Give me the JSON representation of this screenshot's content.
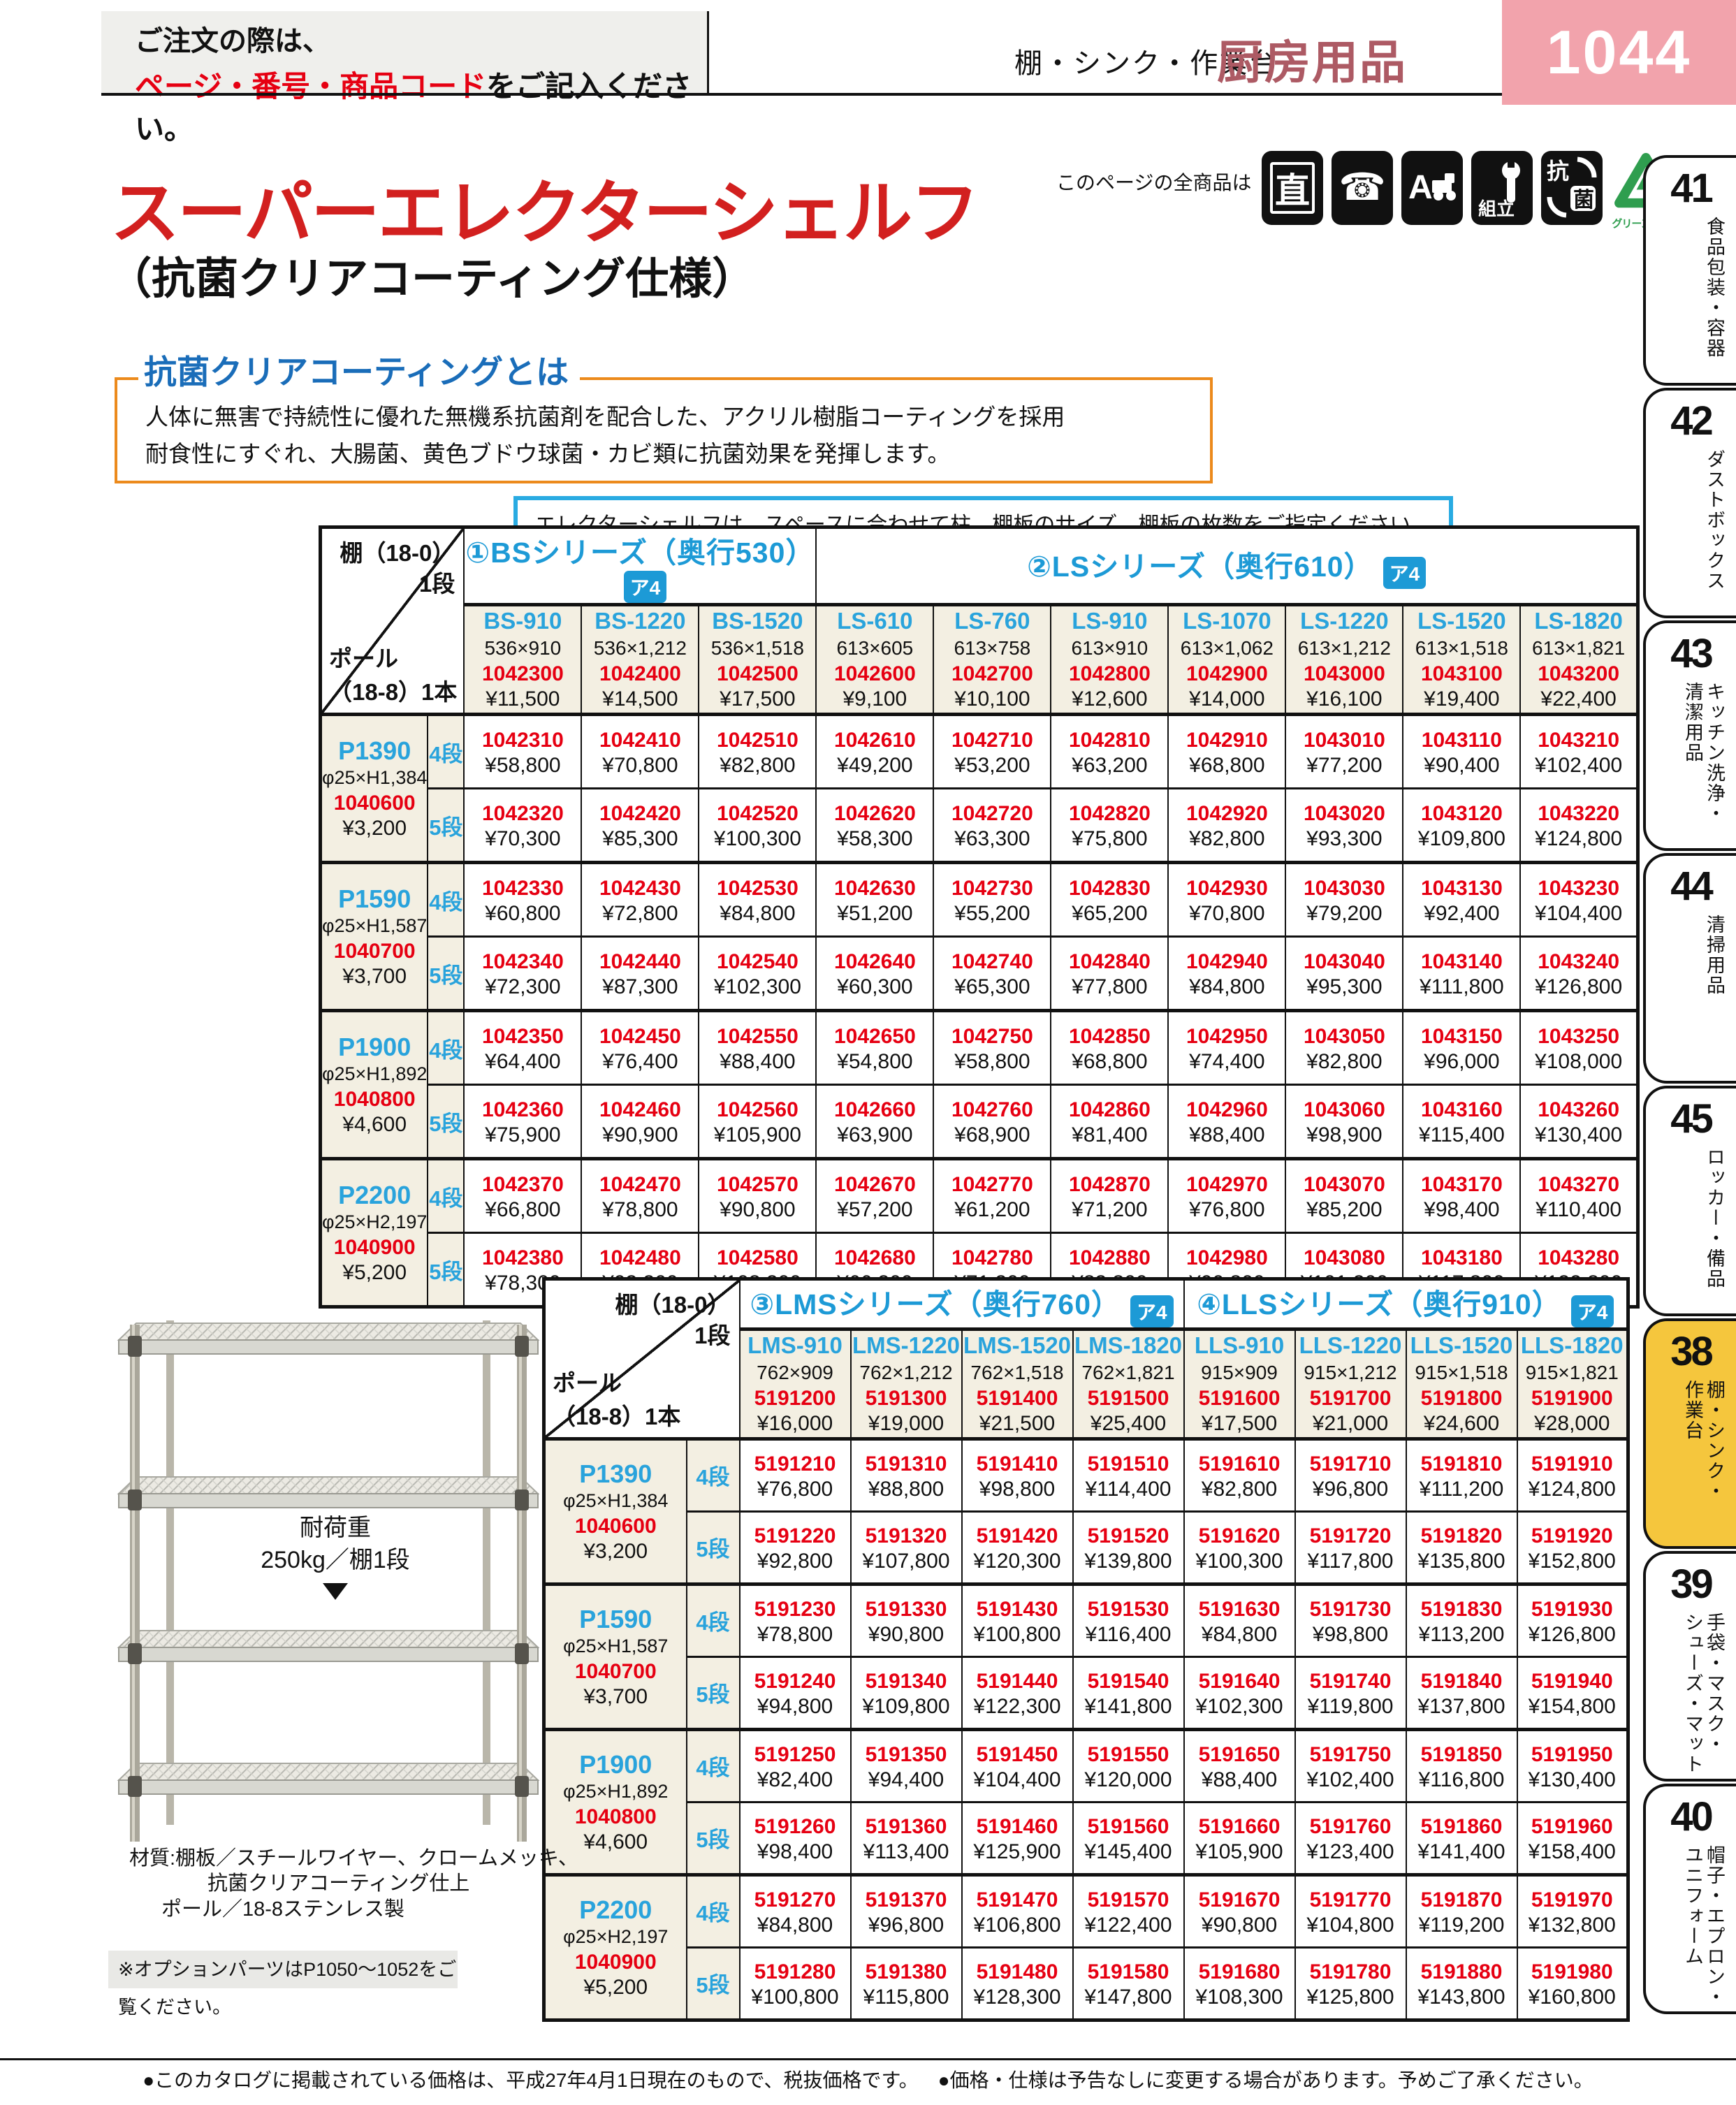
{
  "page": {
    "order_line1": "ご注文の際は、",
    "order_line2_em": "ページ・番号・商品コード",
    "order_line2_rest": "をご記入ください。",
    "category": "棚・シンク・作業台",
    "section": "厨房用品",
    "page_number": "1044",
    "footer1": "●このカタログに掲載されている価格は、平成27年4月1日現在のもので、税抜価格です。",
    "footer2": "●価格・仕様は予告なしに変更する場合があります。予めご了承ください。"
  },
  "title": {
    "main": "スーパーエレクターシェルフ",
    "sub": "（抗菌クリアコーティング仕様）",
    "all_products": "このページの全商品は",
    "green_mark_caption": "グリーンマーク",
    "icon_glyphs": {
      "direct": "直",
      "phone": "☎",
      "truck": "A",
      "assembly": "組立",
      "antibacterial_top": "抗",
      "antibacterial_bottom": "菌"
    }
  },
  "coating": {
    "heading": "抗菌クリアコーティングとは",
    "line1": "人体に無害で持続性に優れた無機系抗菌剤を配合した、アクリル樹脂コーティングを採用",
    "line2": "耐食性にすぐれ、大腸菌、黄色ブドウ球菌・カビ類に抗菌効果を発揮します。"
  },
  "spec_note": "エレクターシェルフは、スペースに合わせて柱、棚板のサイズ、棚板の枚数をご指定ください。",
  "corner": {
    "shelf": "棚（18-0）",
    "shelf_unit": "1段",
    "pole": "ポール",
    "pole_unit": "（18-8）1本"
  },
  "product": {
    "load_title": "耐荷重",
    "load_value": "250kg／棚1段",
    "material1": "材質:棚板／スチールワイヤー、クロームメッキ、",
    "material2": "抗菌クリアコーティング仕上",
    "material3": "ポール／18-8ステンレス製",
    "option_note": "※オプションパーツはP1050～1052をご覧ください。"
  },
  "colors": {
    "code_red": "#e60012",
    "header_cyan": "#29a3dc",
    "series_blue": "#1d9ad6",
    "title_red": "#d2201f",
    "page_block_pink": "#f2a3ac",
    "section_maroon": "#ad5a64",
    "active_tab_yellow": "#f5c63d",
    "box_orange": "#ec8a1c",
    "note_blue": "#29abe2",
    "green_mark": "#2f9e4f"
  },
  "sidebar": [
    {
      "num": "41",
      "label": "食品包装・容器",
      "active": false
    },
    {
      "num": "42",
      "label": "ダストボックス",
      "active": false
    },
    {
      "num": "43",
      "label": "キッチン洗浄・\n清潔用品",
      "active": false
    },
    {
      "num": "44",
      "label": "清掃用品",
      "active": false
    },
    {
      "num": "45",
      "label": "ロッカー・備品",
      "active": false
    },
    {
      "num": "38",
      "label": "棚・シンク・\n作業台",
      "active": true
    },
    {
      "num": "39",
      "label": "手袋・マスク・\nシューズ・マット",
      "active": false
    },
    {
      "num": "40",
      "label": "帽子・エプロン・\nユニフォーム",
      "active": false
    }
  ],
  "tables": [
    {
      "series": [
        {
          "label": "①BSシリーズ（奥行530）",
          "badge": "ア4",
          "span": 3
        },
        {
          "label": "②LSシリーズ（奥行610）",
          "badge": "ア4",
          "span": 7
        }
      ],
      "columns": [
        {
          "name": "BS-910",
          "size": "536×910",
          "code": "1042300",
          "price": "¥11,500"
        },
        {
          "name": "BS-1220",
          "size": "536×1,212",
          "code": "1042400",
          "price": "¥14,500"
        },
        {
          "name": "BS-1520",
          "size": "536×1,518",
          "code": "1042500",
          "price": "¥17,500"
        },
        {
          "name": "LS-610",
          "size": "613×605",
          "code": "1042600",
          "price": "¥9,100"
        },
        {
          "name": "LS-760",
          "size": "613×758",
          "code": "1042700",
          "price": "¥10,100"
        },
        {
          "name": "LS-910",
          "size": "613×910",
          "code": "1042800",
          "price": "¥12,600"
        },
        {
          "name": "LS-1070",
          "size": "613×1,062",
          "code": "1042900",
          "price": "¥14,000"
        },
        {
          "name": "LS-1220",
          "size": "613×1,212",
          "code": "1043000",
          "price": "¥16,100"
        },
        {
          "name": "LS-1520",
          "size": "613×1,518",
          "code": "1043100",
          "price": "¥19,400"
        },
        {
          "name": "LS-1820",
          "size": "613×1,821",
          "code": "1043200",
          "price": "¥22,400"
        }
      ],
      "groups": [
        {
          "pole": {
            "name": "P1390",
            "size": "φ25×H1,384",
            "code": "1040600",
            "price": "¥3,200"
          },
          "tiers": [
            {
              "label": "4段",
              "codes": [
                "1042310",
                "1042410",
                "1042510",
                "1042610",
                "1042710",
                "1042810",
                "1042910",
                "1043010",
                "1043110",
                "1043210"
              ],
              "prices": [
                "¥58,800",
                "¥70,800",
                "¥82,800",
                "¥49,200",
                "¥53,200",
                "¥63,200",
                "¥68,800",
                "¥77,200",
                "¥90,400",
                "¥102,400"
              ]
            },
            {
              "label": "5段",
              "codes": [
                "1042320",
                "1042420",
                "1042520",
                "1042620",
                "1042720",
                "1042820",
                "1042920",
                "1043020",
                "1043120",
                "1043220"
              ],
              "prices": [
                "¥70,300",
                "¥85,300",
                "¥100,300",
                "¥58,300",
                "¥63,300",
                "¥75,800",
                "¥82,800",
                "¥93,300",
                "¥109,800",
                "¥124,800"
              ]
            }
          ]
        },
        {
          "pole": {
            "name": "P1590",
            "size": "φ25×H1,587",
            "code": "1040700",
            "price": "¥3,700"
          },
          "tiers": [
            {
              "label": "4段",
              "codes": [
                "1042330",
                "1042430",
                "1042530",
                "1042630",
                "1042730",
                "1042830",
                "1042930",
                "1043030",
                "1043130",
                "1043230"
              ],
              "prices": [
                "¥60,800",
                "¥72,800",
                "¥84,800",
                "¥51,200",
                "¥55,200",
                "¥65,200",
                "¥70,800",
                "¥79,200",
                "¥92,400",
                "¥104,400"
              ]
            },
            {
              "label": "5段",
              "codes": [
                "1042340",
                "1042440",
                "1042540",
                "1042640",
                "1042740",
                "1042840",
                "1042940",
                "1043040",
                "1043140",
                "1043240"
              ],
              "prices": [
                "¥72,300",
                "¥87,300",
                "¥102,300",
                "¥60,300",
                "¥65,300",
                "¥77,800",
                "¥84,800",
                "¥95,300",
                "¥111,800",
                "¥126,800"
              ]
            }
          ]
        },
        {
          "pole": {
            "name": "P1900",
            "size": "φ25×H1,892",
            "code": "1040800",
            "price": "¥4,600"
          },
          "tiers": [
            {
              "label": "4段",
              "codes": [
                "1042350",
                "1042450",
                "1042550",
                "1042650",
                "1042750",
                "1042850",
                "1042950",
                "1043050",
                "1043150",
                "1043250"
              ],
              "prices": [
                "¥64,400",
                "¥76,400",
                "¥88,400",
                "¥54,800",
                "¥58,800",
                "¥68,800",
                "¥74,400",
                "¥82,800",
                "¥96,000",
                "¥108,000"
              ]
            },
            {
              "label": "5段",
              "codes": [
                "1042360",
                "1042460",
                "1042560",
                "1042660",
                "1042760",
                "1042860",
                "1042960",
                "1043060",
                "1043160",
                "1043260"
              ],
              "prices": [
                "¥75,900",
                "¥90,900",
                "¥105,900",
                "¥63,900",
                "¥68,900",
                "¥81,400",
                "¥88,400",
                "¥98,900",
                "¥115,400",
                "¥130,400"
              ]
            }
          ]
        },
        {
          "pole": {
            "name": "P2200",
            "size": "φ25×H2,197",
            "code": "1040900",
            "price": "¥5,200"
          },
          "tiers": [
            {
              "label": "4段",
              "codes": [
                "1042370",
                "1042470",
                "1042570",
                "1042670",
                "1042770",
                "1042870",
                "1042970",
                "1043070",
                "1043170",
                "1043270"
              ],
              "prices": [
                "¥66,800",
                "¥78,800",
                "¥90,800",
                "¥57,200",
                "¥61,200",
                "¥71,200",
                "¥76,800",
                "¥85,200",
                "¥98,400",
                "¥110,400"
              ]
            },
            {
              "label": "5段",
              "codes": [
                "1042380",
                "1042480",
                "1042580",
                "1042680",
                "1042780",
                "1042880",
                "1042980",
                "1043080",
                "1043180",
                "1043280"
              ],
              "prices": [
                "¥78,300",
                "¥93,300",
                "¥108,300",
                "¥66,300",
                "¥71,300",
                "¥83,800",
                "¥90,800",
                "¥101,300",
                "¥117,800",
                "¥132,800"
              ]
            }
          ]
        }
      ]
    },
    {
      "series": [
        {
          "label": "③LMSシリーズ（奥行760）",
          "badge": "ア4",
          "span": 4
        },
        {
          "label": "④LLSシリーズ（奥行910）",
          "badge": "ア4",
          "span": 4
        }
      ],
      "columns": [
        {
          "name": "LMS-910",
          "size": "762×909",
          "code": "5191200",
          "price": "¥16,000"
        },
        {
          "name": "LMS-1220",
          "size": "762×1,212",
          "code": "5191300",
          "price": "¥19,000"
        },
        {
          "name": "LMS-1520",
          "size": "762×1,518",
          "code": "5191400",
          "price": "¥21,500"
        },
        {
          "name": "LMS-1820",
          "size": "762×1,821",
          "code": "5191500",
          "price": "¥25,400"
        },
        {
          "name": "LLS-910",
          "size": "915×909",
          "code": "5191600",
          "price": "¥17,500"
        },
        {
          "name": "LLS-1220",
          "size": "915×1,212",
          "code": "5191700",
          "price": "¥21,000"
        },
        {
          "name": "LLS-1520",
          "size": "915×1,518",
          "code": "5191800",
          "price": "¥24,600"
        },
        {
          "name": "LLS-1820",
          "size": "915×1,821",
          "code": "5191900",
          "price": "¥28,000"
        }
      ],
      "groups": [
        {
          "pole": {
            "name": "P1390",
            "size": "φ25×H1,384",
            "code": "1040600",
            "price": "¥3,200"
          },
          "tiers": [
            {
              "label": "4段",
              "codes": [
                "5191210",
                "5191310",
                "5191410",
                "5191510",
                "5191610",
                "5191710",
                "5191810",
                "5191910"
              ],
              "prices": [
                "¥76,800",
                "¥88,800",
                "¥98,800",
                "¥114,400",
                "¥82,800",
                "¥96,800",
                "¥111,200",
                "¥124,800"
              ]
            },
            {
              "label": "5段",
              "codes": [
                "5191220",
                "5191320",
                "5191420",
                "5191520",
                "5191620",
                "5191720",
                "5191820",
                "5191920"
              ],
              "prices": [
                "¥92,800",
                "¥107,800",
                "¥120,300",
                "¥139,800",
                "¥100,300",
                "¥117,800",
                "¥135,800",
                "¥152,800"
              ]
            }
          ]
        },
        {
          "pole": {
            "name": "P1590",
            "size": "φ25×H1,587",
            "code": "1040700",
            "price": "¥3,700"
          },
          "tiers": [
            {
              "label": "4段",
              "codes": [
                "5191230",
                "5191330",
                "5191430",
                "5191530",
                "5191630",
                "5191730",
                "5191830",
                "5191930"
              ],
              "prices": [
                "¥78,800",
                "¥90,800",
                "¥100,800",
                "¥116,400",
                "¥84,800",
                "¥98,800",
                "¥113,200",
                "¥126,800"
              ]
            },
            {
              "label": "5段",
              "codes": [
                "5191240",
                "5191340",
                "5191440",
                "5191540",
                "5191640",
                "5191740",
                "5191840",
                "5191940"
              ],
              "prices": [
                "¥94,800",
                "¥109,800",
                "¥122,300",
                "¥141,800",
                "¥102,300",
                "¥119,800",
                "¥137,800",
                "¥154,800"
              ]
            }
          ]
        },
        {
          "pole": {
            "name": "P1900",
            "size": "φ25×H1,892",
            "code": "1040800",
            "price": "¥4,600"
          },
          "tiers": [
            {
              "label": "4段",
              "codes": [
                "5191250",
                "5191350",
                "5191450",
                "5191550",
                "5191650",
                "5191750",
                "5191850",
                "5191950"
              ],
              "prices": [
                "¥82,400",
                "¥94,400",
                "¥104,400",
                "¥120,000",
                "¥88,400",
                "¥102,400",
                "¥116,800",
                "¥130,400"
              ]
            },
            {
              "label": "5段",
              "codes": [
                "5191260",
                "5191360",
                "5191460",
                "5191560",
                "5191660",
                "5191760",
                "5191860",
                "5191960"
              ],
              "prices": [
                "¥98,400",
                "¥113,400",
                "¥125,900",
                "¥145,400",
                "¥105,900",
                "¥123,400",
                "¥141,400",
                "¥158,400"
              ]
            }
          ]
        },
        {
          "pole": {
            "name": "P2200",
            "size": "φ25×H2,197",
            "code": "1040900",
            "price": "¥5,200"
          },
          "tiers": [
            {
              "label": "4段",
              "codes": [
                "5191270",
                "5191370",
                "5191470",
                "5191570",
                "5191670",
                "5191770",
                "5191870",
                "5191970"
              ],
              "prices": [
                "¥84,800",
                "¥96,800",
                "¥106,800",
                "¥122,400",
                "¥90,800",
                "¥104,800",
                "¥119,200",
                "¥132,800"
              ]
            },
            {
              "label": "5段",
              "codes": [
                "5191280",
                "5191380",
                "5191480",
                "5191580",
                "5191680",
                "5191780",
                "5191880",
                "5191980"
              ],
              "prices": [
                "¥100,800",
                "¥115,800",
                "¥128,300",
                "¥147,800",
                "¥108,300",
                "¥125,800",
                "¥143,800",
                "¥160,800"
              ]
            }
          ]
        }
      ]
    }
  ]
}
